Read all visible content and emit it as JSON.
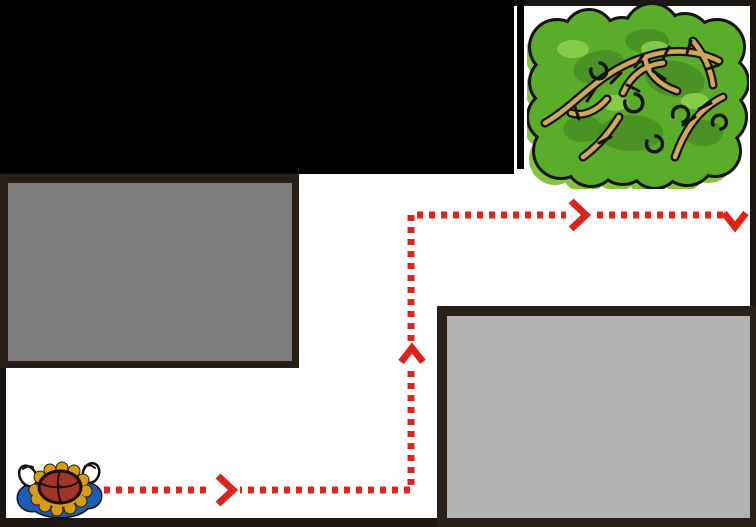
{
  "scene": {
    "width": 756,
    "height": 527,
    "description": "maze path puzzle: character walks dotted route to bush",
    "colors": {
      "background": "#ffffff",
      "frame": "#1d1713",
      "wall_black": "#000000",
      "obstacle_border": "#272019",
      "obstacle1_fill": "#7d7d7d",
      "obstacle2_fill": "#b2b2b2",
      "path_red": "#dd241c",
      "bush_green": "#5aad2a",
      "bush_dark": "#478f22",
      "bush_light": "#8ad04c",
      "bush_shadow": "#84c53f",
      "branch_tan": "#d2a75a",
      "outline_black": "#151310",
      "char_blue": "#1d5cb4",
      "char_red": "#a13425",
      "char_gold": "#d79b15",
      "char_white": "#ffffff"
    },
    "rects": [
      {
        "name": "frame-top",
        "x": 0,
        "y": 0,
        "w": 756,
        "h": 6,
        "color": "frame"
      },
      {
        "name": "frame-left",
        "x": 0,
        "y": 0,
        "w": 6,
        "h": 527,
        "color": "frame"
      },
      {
        "name": "frame-right",
        "x": 750,
        "y": 0,
        "w": 6,
        "h": 527,
        "color": "frame"
      },
      {
        "name": "frame-bottom",
        "x": 0,
        "y": 518,
        "w": 756,
        "h": 9,
        "color": "frame"
      },
      {
        "name": "black-wall-block",
        "x": 0,
        "y": 0,
        "w": 514,
        "h": 174,
        "color": "wall_black"
      },
      {
        "name": "bush-pen-left-wall",
        "x": 517,
        "y": 0,
        "w": 7,
        "h": 169,
        "color": "wall_black"
      }
    ],
    "obstacles": [
      {
        "name": "obstacle-gray-left",
        "x": 0,
        "y": 174,
        "w": 299,
        "h": 194,
        "border": {
          "l": 8,
          "t": 9,
          "r": 7,
          "b": 7
        },
        "fill": "obstacle1_fill"
      },
      {
        "name": "obstacle-gray-right",
        "x": 437,
        "y": 306,
        "w": 319,
        "h": 221,
        "border": {
          "l": 10,
          "t": 10,
          "r": 6,
          "b": 9
        },
        "fill": "obstacle2_fill"
      }
    ],
    "path": {
      "points": [
        [
          80,
          490
        ],
        [
          411,
          490
        ],
        [
          411,
          215
        ],
        [
          723,
          215
        ]
      ],
      "stroke_width": 7,
      "dash": [
        6,
        6
      ],
      "halos": [
        {
          "x": 210,
          "y": 483,
          "w": 30,
          "h": 14
        },
        {
          "x": 403,
          "y": 343,
          "w": 17,
          "h": 24
        },
        {
          "x": 566,
          "y": 208,
          "w": 26,
          "h": 14
        }
      ],
      "chevrons": [
        {
          "name": "path-arrow-right-1",
          "direction": "right",
          "d": "M 218,476 L 233,490 L 218,504"
        },
        {
          "name": "path-arrow-up",
          "direction": "up",
          "d": "M 401,362 L 412,348 L 423,362"
        },
        {
          "name": "path-arrow-right-2",
          "direction": "right",
          "d": "M 571,201 L 586,215 L 571,229"
        },
        {
          "name": "path-arrow-down-end",
          "direction": "down",
          "d": "M 724,213 L 735,227 L 746,213"
        }
      ]
    },
    "sprites": {
      "bush": {
        "name": "bush-goal",
        "x": 527,
        "y": 5,
        "w": 222,
        "h": 184
      },
      "character": {
        "name": "player-character",
        "x": 12,
        "y": 456,
        "w": 96,
        "h": 62
      }
    }
  }
}
